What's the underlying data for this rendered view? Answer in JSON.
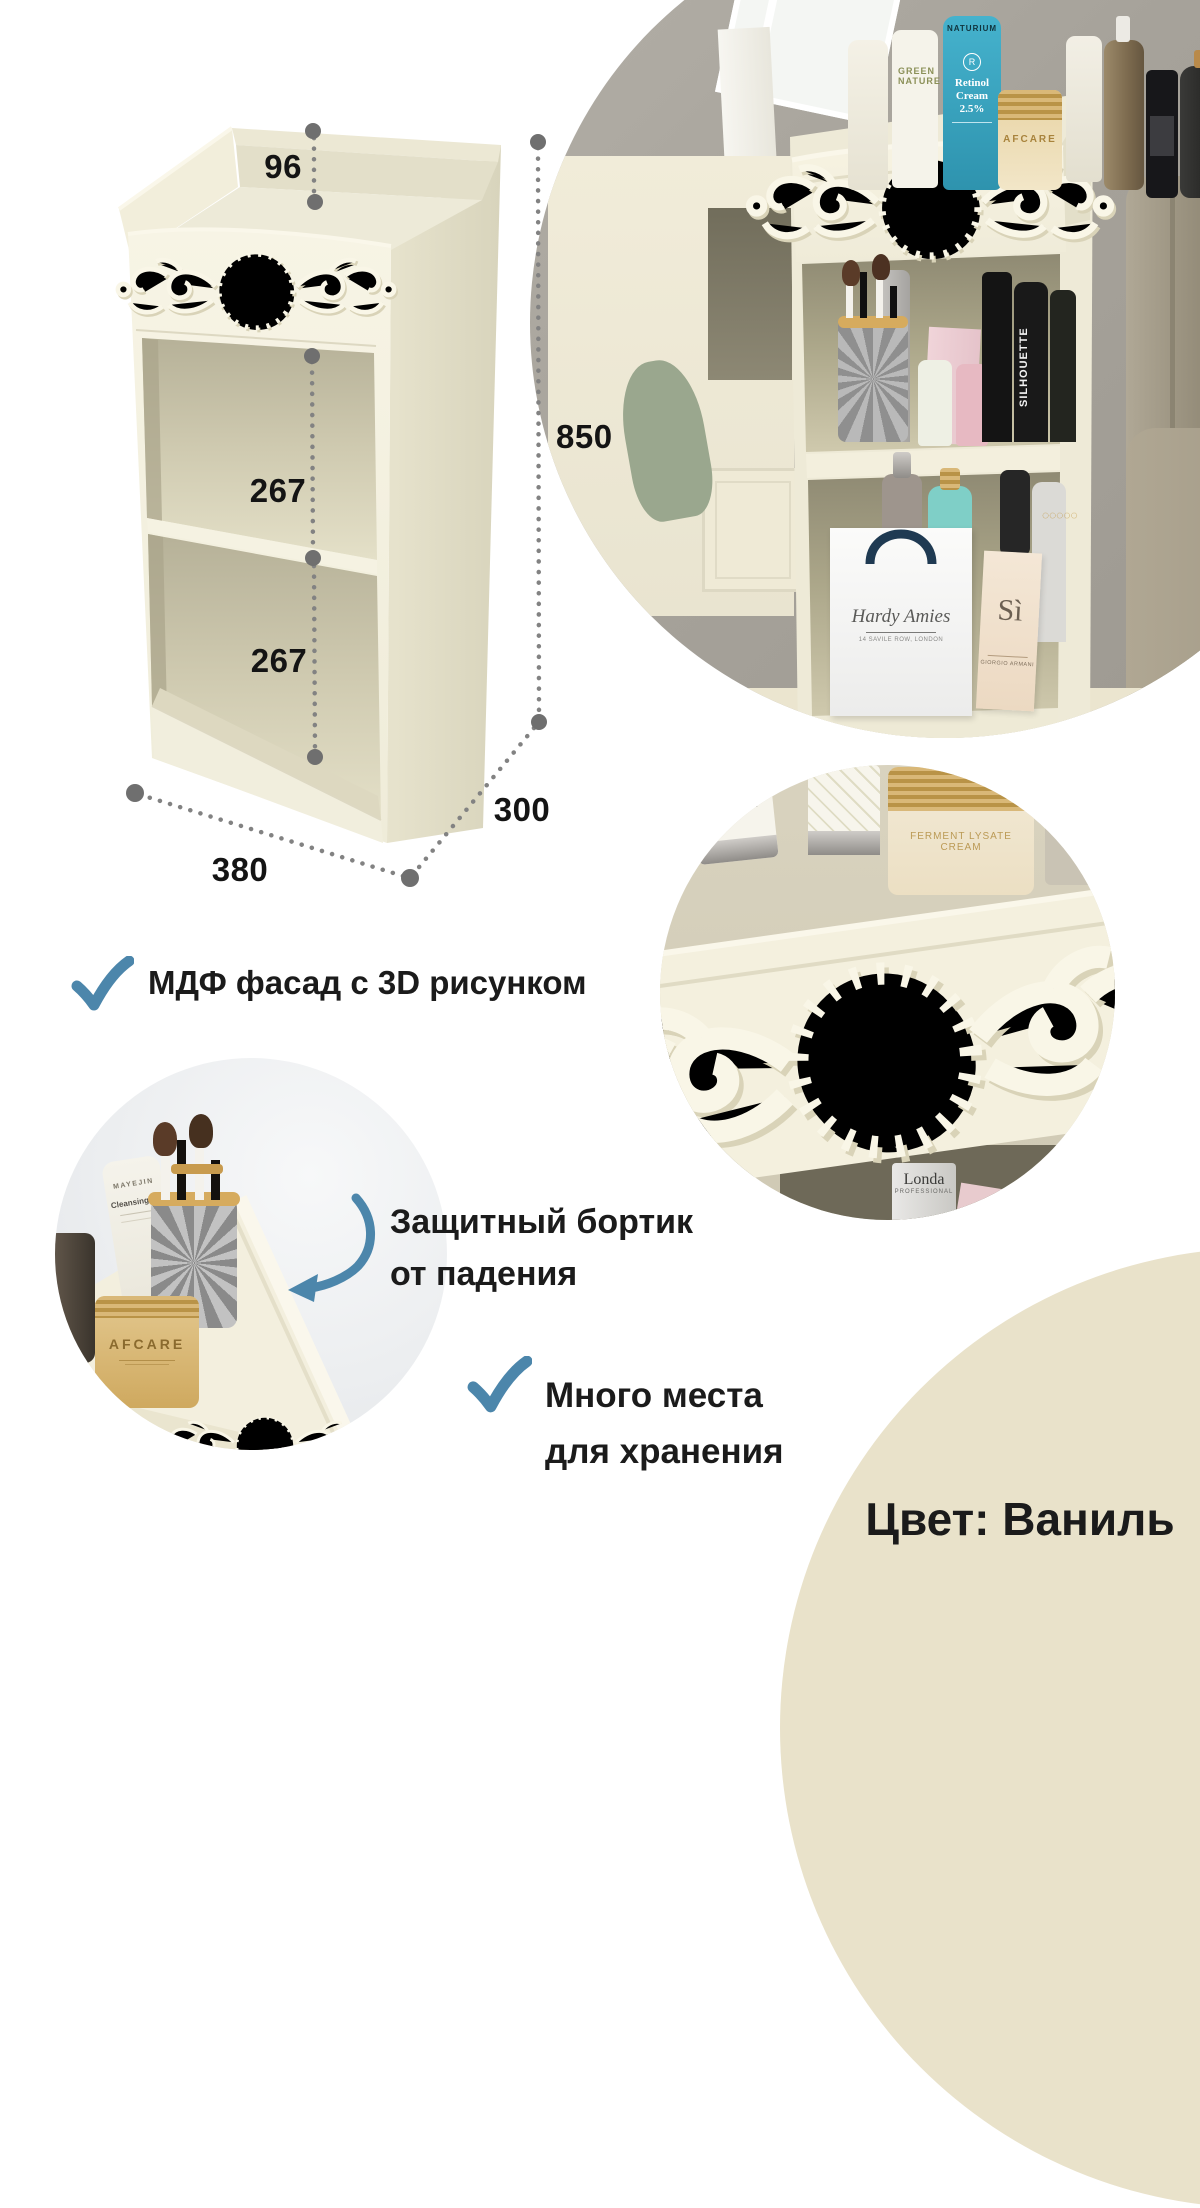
{
  "dimensions": {
    "rail_height": "96",
    "opening_top": "267",
    "opening_bottom": "267",
    "height": "850",
    "depth": "300",
    "width": "380"
  },
  "features": {
    "mdf": "МДФ фасад с 3D рисунком",
    "guard_line1": "Защитный бортик",
    "guard_line2": "от падения",
    "storage_line1": "Много места",
    "storage_line2": "для хранения"
  },
  "color_label": "Цвет: Ваниль",
  "colors": {
    "accent_blue": "#4c86ab",
    "vanilla": "#f3efdf",
    "vanilla_dark": "#d9d4bc",
    "circle_cream": "#e9e2ca",
    "text": "#1a1a1a"
  },
  "products": {
    "naturium_brand": "NATURIUM",
    "naturium_name": "Retinol Cream 2.5%",
    "green_line1": "GREEN",
    "green_line2": "NATURE",
    "afcare_top": "AFCARE",
    "bag_brand": "Hardy Amies",
    "bag_sub": "14 SAVILE ROW, LONDON",
    "perfume_name": "Sì",
    "perfume_brand": "GIORGIO ARMANI",
    "spray": "SILHOUETTE",
    "londa_brand": "Londa",
    "londa_sub": "PROFESSIONAL",
    "jar_line1": "FERMENT LYSATE",
    "jar_line2": "CREAM",
    "mayejin": "MAYEJIN",
    "cleansing_name": "Cleansing Oil",
    "afcare_jar": "AFCARE"
  }
}
